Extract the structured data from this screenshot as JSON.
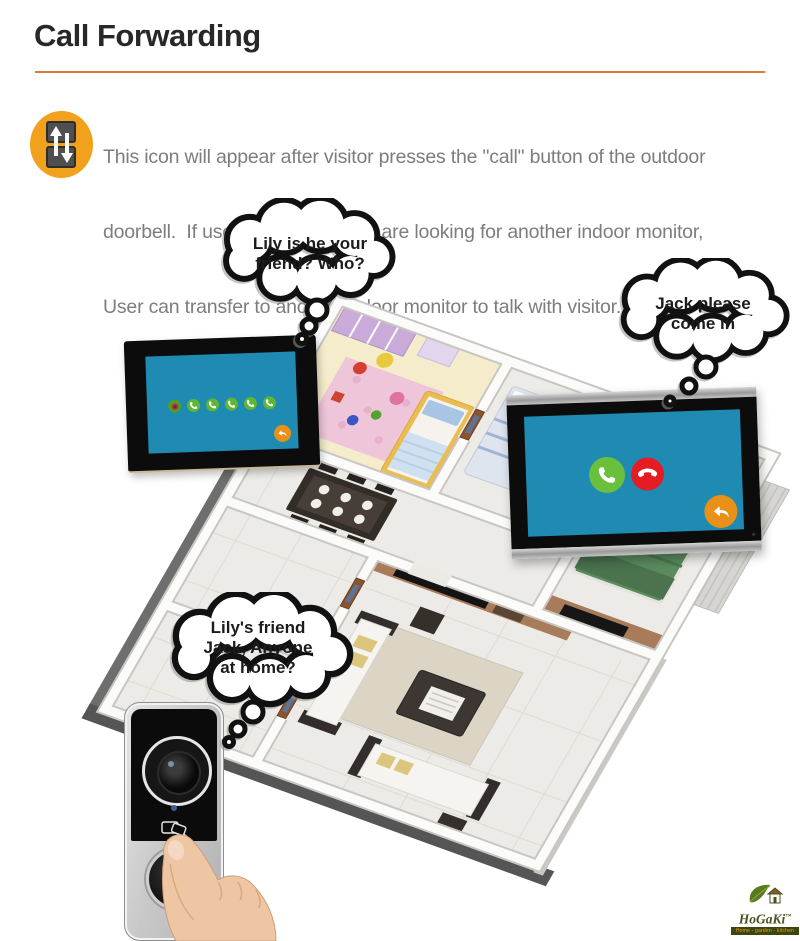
{
  "header": {
    "title": "Call Forwarding",
    "title_color": "#282828",
    "divider_color": "#dd7a3e",
    "feature_icon": {
      "name": "call-transfer-icon",
      "bg_color": "#f1a11c",
      "monitor_color": "#4f4f4f",
      "arrow_color": "#ffffff"
    },
    "description_lines": [
      "This icon will appear after visitor presses the \"call\" button of the outdoor",
      "doorbell.  If user find that visitors are looking for another indoor monitor,",
      "User can transfer to another indoor monitor to talk with visitor."
    ],
    "description_color": "#7d7d7d"
  },
  "thought_bubbles": [
    {
      "lines": [
        "Lily is he your",
        "friend? Who?"
      ]
    },
    {
      "lines": [
        "Jack please",
        "come in"
      ]
    },
    {
      "lines": [
        "Lily's friend",
        "Jack, Anyone",
        "at home?"
      ]
    }
  ],
  "monitors": {
    "screen_color": "#1f8ab2",
    "frame_color": "#0c0c0c",
    "left": {
      "source_icon_color": "#4e9e28",
      "forward_icon_color": "#5cb832",
      "forward_icon_count": 5,
      "back_icon_color": "#e89018"
    },
    "right": {
      "answer_icon_color": "#6abf3c",
      "hangup_icon_color": "#e61c24",
      "back_icon_color": "#e89018",
      "bezel_trim_color": "#b9b9b9"
    }
  },
  "doorbell": {
    "body_color": "#c9c9c9",
    "panel_color": "#0b0b0b",
    "indicator_color": "#3d5f8a"
  },
  "logo": {
    "name": "HoGaKi",
    "trademark": "™",
    "tagline": "Home - garden - kitchen",
    "name_color": "#4a5220",
    "tagline_color": "#f0a01c",
    "bar_color": "#3b470e",
    "leaf_color": "#5a7a1e"
  }
}
